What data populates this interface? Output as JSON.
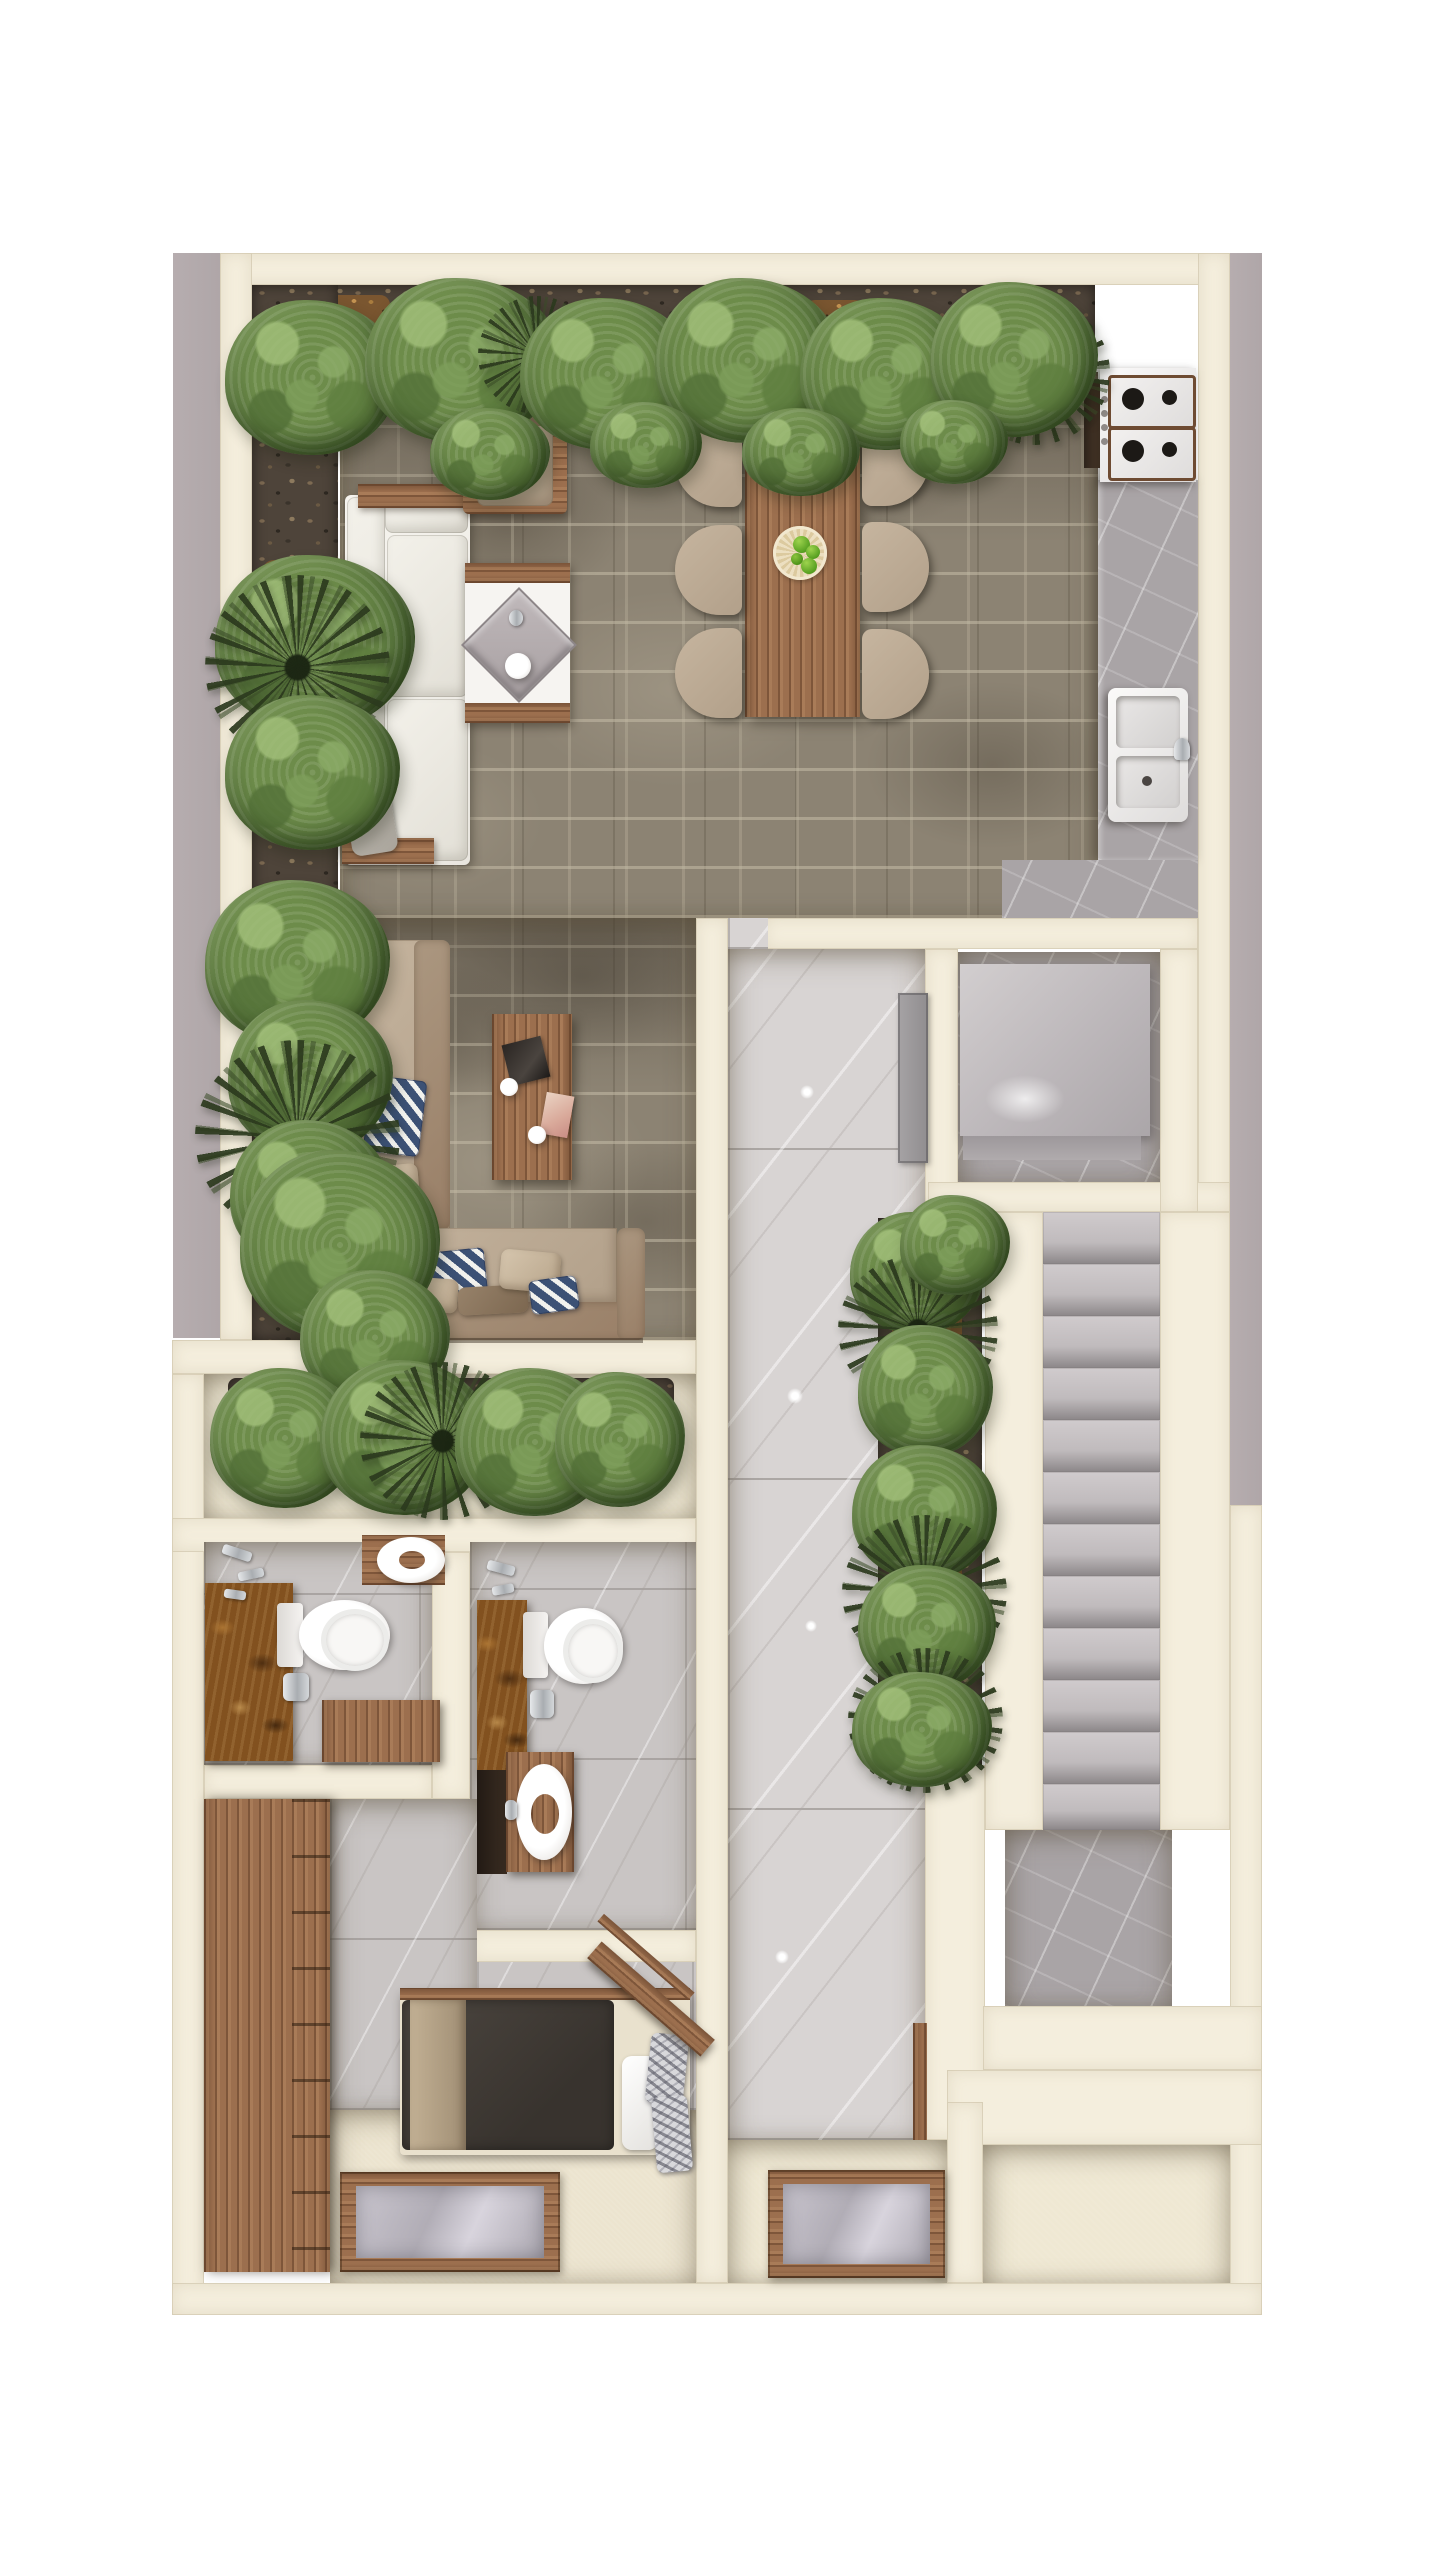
{
  "meta": {
    "kind": "architectural-floor-plan",
    "view": "top-down 3d rendered plan, single level, no text labels",
    "canvas": {
      "width": 1440,
      "height": 2560
    }
  },
  "palette": {
    "page_background": "#ffffff",
    "exterior_shadow_band": "#b2a9ab",
    "wall_cream": "#f4eedd",
    "stone_floor": "#8c8373",
    "hall_tile": "#d8d4d3",
    "bath_tile": "#c9c5c4",
    "gray_marble": "#a9a4a6",
    "wood": "#9c6f4e",
    "foliage_green": "#54703a",
    "dark_palm": "#2c3a1e",
    "sofa_white": "#f1efe9",
    "sofa_beige": "#bfae99",
    "pillow_navy": "#3c5175",
    "rust_vanity": "#82511f",
    "bed_duvet": "#46403b",
    "glass_skylight": "#b7b3bb"
  },
  "rooms": [
    {
      "label": "Open living and dining terrace with stone tile floor, perimeter planters, white corner sofa, lounge armchair, fire table, six-seat dining table and beige sectional sofa with coffee table"
    },
    {
      "label": "Kitchen run along right wall with marble counter, four-burner gas cooktop and double sink"
    },
    {
      "label": "Central hallway with polished marble tile and linear planter of shrubs and palms"
    },
    {
      "label": "Storage room with large gray cabinet volume"
    },
    {
      "label": "Staircase of twelve marble steps descending to lower landing"
    },
    {
      "label": "Enclosed planter bed with hedge row"
    },
    {
      "label": "Bathroom one with rust marble vanity wall, toilet, round basin and wood door panel"
    },
    {
      "label": "Bathroom two with rust marble vanity wall, toilet and round vessel sink on wood cabinet"
    },
    {
      "label": "Bedroom with full-height wood wardrobe, single bed with dark duvet and diagonal wood headboard shelf"
    },
    {
      "label": "Empty room at lower right"
    },
    {
      "label": "Entry zone with two wood-framed floor skylights"
    }
  ],
  "furniture": {
    "living": [
      "white-corner-sofa",
      "wood-ledges",
      "lounge-armchair",
      "fire-table-with-faucet-and-bowl",
      "dining-table",
      "six-dining-chairs",
      "fruit-plate-with-green-apples",
      "beige-sectional-sofa",
      "chevron-navy-pillows",
      "beige-and-brown-pillows",
      "coffee-table-with-magazines-and-two-cups"
    ],
    "kitchen": [
      "gas-cooktop-4-burners",
      "control-knobs",
      "oven-slot",
      "marble-counter",
      "double-basin-sink",
      "faucet"
    ],
    "bath_a": [
      "rust-marble-vanity",
      "toilet",
      "toilet-paper-holder",
      "wall-faucets",
      "round-basin-on-wood-counter",
      "wood-door-panel"
    ],
    "bath_b": [
      "rust-marble-vanity",
      "toilet",
      "toilet-paper-holder",
      "wall-faucets",
      "round-vessel-sink-on-wood-cabinet",
      "dark-shower-niche"
    ],
    "bedroom": [
      "wood-wardrobe-with-shelves",
      "single-bed-dark-duvet",
      "beige-throw",
      "white-pillow",
      "two-patterned-pillows",
      "diagonal-wood-headboard",
      "floor-skylight"
    ],
    "utility": [
      "gray-cabinet-volume",
      "gray-double-door"
    ],
    "outdoor": [
      "hedge-bushes",
      "dark-fan-palms",
      "pebble-planter-beds",
      "bark-mulch"
    ]
  }
}
